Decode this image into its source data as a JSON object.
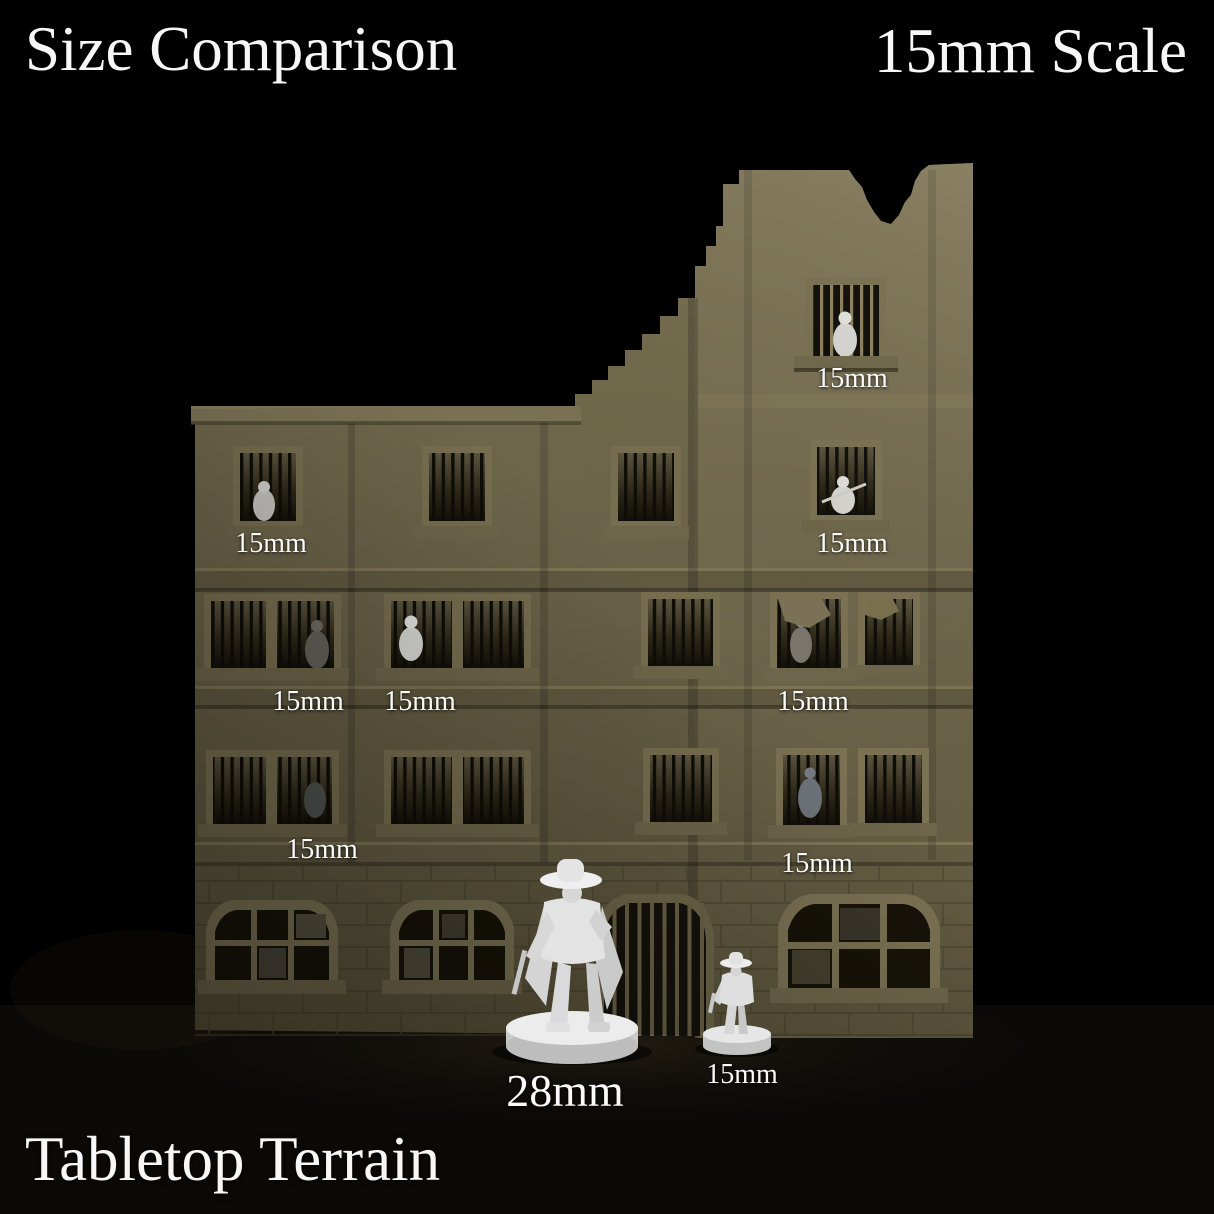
{
  "titles": {
    "left": "Size Comparison",
    "right": "15mm Scale"
  },
  "footer": {
    "brand": "Tabletop Terrain"
  },
  "annotations": {
    "window_labels": [
      {
        "text": "15mm",
        "location": "tower-top-window"
      },
      {
        "text": "15mm",
        "location": "floor4-left-window"
      },
      {
        "text": "15mm",
        "location": "floor4-tower-window"
      },
      {
        "text": "15mm",
        "location": "floor3-left-window-1"
      },
      {
        "text": "15mm",
        "location": "floor3-left-window-2"
      },
      {
        "text": "15mm",
        "location": "floor3-right-window"
      },
      {
        "text": "15mm",
        "location": "floor2-left-window"
      },
      {
        "text": "15mm",
        "location": "floor2-right-window"
      }
    ],
    "figure_labels": [
      {
        "text": "28mm",
        "figure": "large-miniature"
      },
      {
        "text": "15mm",
        "figure": "small-miniature"
      }
    ]
  },
  "scene": {
    "subject": "Ruined multi-story stone building with barred windows, miniature figures shown for scale",
    "colors": {
      "background": "#000000",
      "wall": "#6b6349",
      "wall_light": "#7e7658",
      "wall_dark": "#55503a",
      "window_dark": "#15120b",
      "bar_light": "#8a7f5e",
      "miniature_white": "#e8e8e8"
    }
  }
}
